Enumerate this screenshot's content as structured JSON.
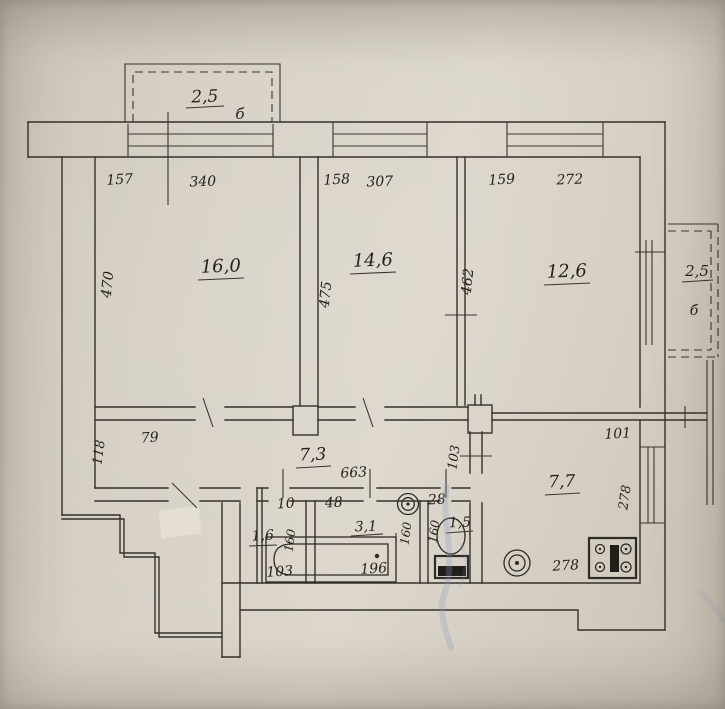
{
  "document": {
    "kind": "apartment floor plan scan"
  },
  "palette": {
    "paper": "#d7d1c6",
    "ink": "#2c2824",
    "blue_ink": "#8a9cc8"
  },
  "balconies": {
    "top": {
      "area": "2,5",
      "type_label": "б"
    },
    "right": {
      "area": "2,5",
      "type_label": "б"
    }
  },
  "rooms": {
    "room1": {
      "area": "16,0",
      "top_dims": [
        "157",
        "340"
      ],
      "side_dim": "470"
    },
    "room2": {
      "area": "14,6",
      "top_dims": [
        "158",
        "307"
      ],
      "side_dim": "475"
    },
    "room3": {
      "area": "12,6",
      "top_dims": [
        "159",
        "272"
      ],
      "side_dim": "462"
    },
    "hallway": {
      "area": "7,3",
      "left_side_dim": "118",
      "left_top_dim": "79",
      "length_dim": "663",
      "right_side_dim": "103"
    },
    "kitchen": {
      "area": "7,7",
      "top_dim": "101",
      "side_dim": "278",
      "bottom_dim": "278"
    },
    "closet": {
      "area": "1,6",
      "top_dim": "10",
      "side_dim": "160",
      "bottom_dim": "103"
    },
    "bathroom": {
      "area": "3,1",
      "top_dim": "48",
      "side_dim": "160",
      "tub_dim": "196"
    },
    "wc": {
      "area": "1,5",
      "top_dim": "28",
      "side_dim": "160",
      "tank_dim": "94"
    }
  }
}
